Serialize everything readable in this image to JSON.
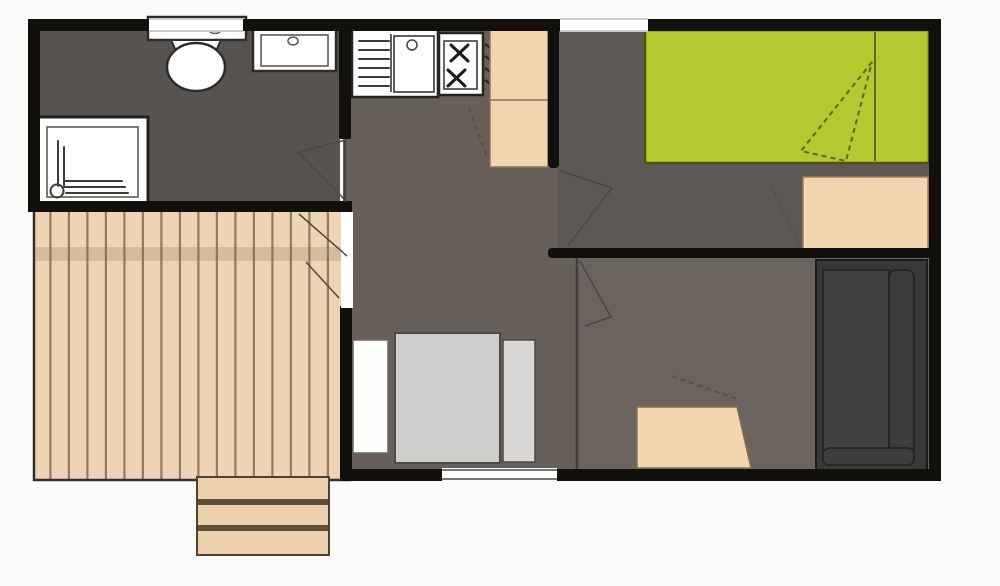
{
  "diagram": {
    "type": "floor-plan",
    "title": "Mobile home floor plan (top-down view, no text labels)",
    "rooms": [
      {
        "name": "bathroom",
        "position": "top-left",
        "fixtures": [
          "toilet",
          "washbasin",
          "shower-tray"
        ]
      },
      {
        "name": "kitchen-living",
        "position": "center",
        "fixtures": [
          "sink-with-drainer",
          "two-burner-hob",
          "tall-cabinet",
          "wardrobe",
          "single-bed",
          "pillow"
        ]
      },
      {
        "name": "double-bedroom",
        "position": "top-right",
        "fixtures": [
          "double-bed-green",
          "bedside-unit"
        ]
      },
      {
        "name": "lounge-bedroom",
        "position": "bottom-right",
        "fixtures": [
          "sofa",
          "table"
        ]
      },
      {
        "name": "deck-terrace",
        "position": "bottom-left",
        "fixtures": [
          "wood-plank-decking",
          "entry-steps"
        ]
      }
    ],
    "doors": [
      {
        "name": "bathroom-door",
        "swing": "into-bathroom"
      },
      {
        "name": "double-bedroom-door",
        "swing": "into-bedroom"
      },
      {
        "name": "lounge-door",
        "swing": "into-lounge"
      },
      {
        "name": "deck-double-door",
        "swing": "onto-deck"
      }
    ],
    "windows": [
      "top-wall-bathroom-window",
      "top-wall-hall-window",
      "bottom-wall-living-window"
    ],
    "steps": {
      "count": 3,
      "location": "below-deck"
    }
  },
  "colors": {
    "background": "#fbfbfa",
    "wall": "#12100d",
    "white": "#ffffff",
    "bathroom_floor": "#575350",
    "kitchen_floor": "#665f5a",
    "bedroom_floor": "#5e5854",
    "lounge_floor": "#6b635e",
    "deck": "#eed4b4",
    "deck_line": "#6f5f49",
    "deck_shadow": "#7c6a50",
    "step": "#edd0ae",
    "step_divider": "#5d4c38",
    "green_bed": "#b5c82f",
    "green_bed_edge": "#4b5706",
    "tan": "#f1d6b0",
    "gray_bed": "#cfcecd",
    "gray_pillow": "#d9d8d7",
    "wardrobe_white": "#fdfdfc",
    "sofa_dark": "#3a3737",
    "sofa_mid": "#434040",
    "sofa_back": "#3e3b3b",
    "partition": "#45403c"
  }
}
